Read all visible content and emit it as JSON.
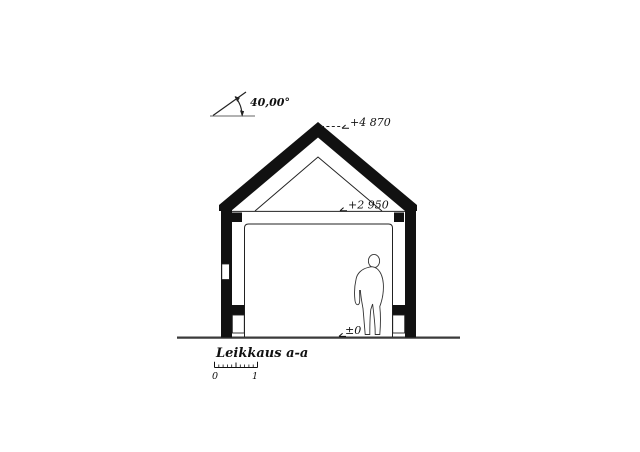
{
  "drawing": {
    "type": "architectural-section-drawing",
    "title": "Leikkaus a-a",
    "roof_angle_label": "40,00°",
    "levels": {
      "ridge": "+4 870",
      "ceiling": "+2 950",
      "floor": "±0"
    },
    "scale_bar": {
      "start_label": "0",
      "end_label": "1"
    },
    "colors": {
      "ink": "#111111",
      "thin_line": "#222222",
      "ground_line": "#3a3a3a",
      "angle_baseline": "#999999",
      "background": "#ffffff"
    }
  }
}
